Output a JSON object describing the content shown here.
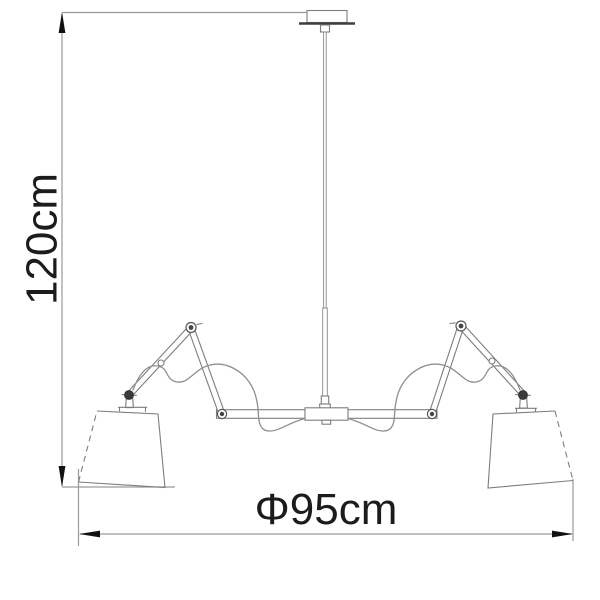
{
  "page": {
    "background": "#ffffff"
  },
  "drawing": {
    "kind": "pendant-lamp-dimension-drawing",
    "labels": {
      "height": "120cm",
      "diameter": "Φ95cm"
    },
    "colors": {
      "outline": "#7d7d7d",
      "dimension_line": "#9a9a9a",
      "arrow": "#111111",
      "text": "#1c1c1c",
      "plate": "#3f3f3f"
    }
  }
}
